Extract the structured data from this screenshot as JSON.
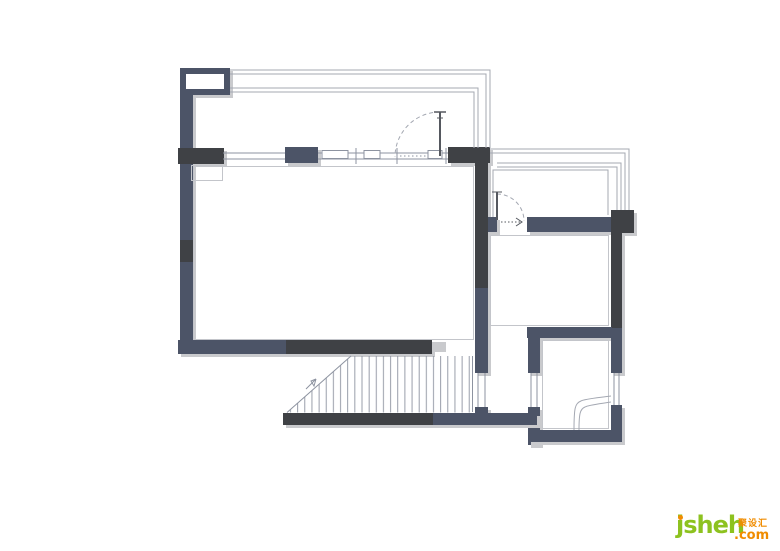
{
  "logo": {
    "brand": "jsheh",
    "tld": ".com",
    "cn": "聚设汇"
  },
  "colors": {
    "wall_slate": "#4c5467",
    "wall_charcoal": "#3f4145",
    "shadow": "#c9cacd",
    "line_thin": "#a4a8b2",
    "line_window": "#8d93a0",
    "line_face": "#c3c5ca",
    "line_dark": "#55585f",
    "logo_green": "#8dc21f",
    "logo_orange": "#f08c00",
    "bg": "#ffffff"
  }
}
